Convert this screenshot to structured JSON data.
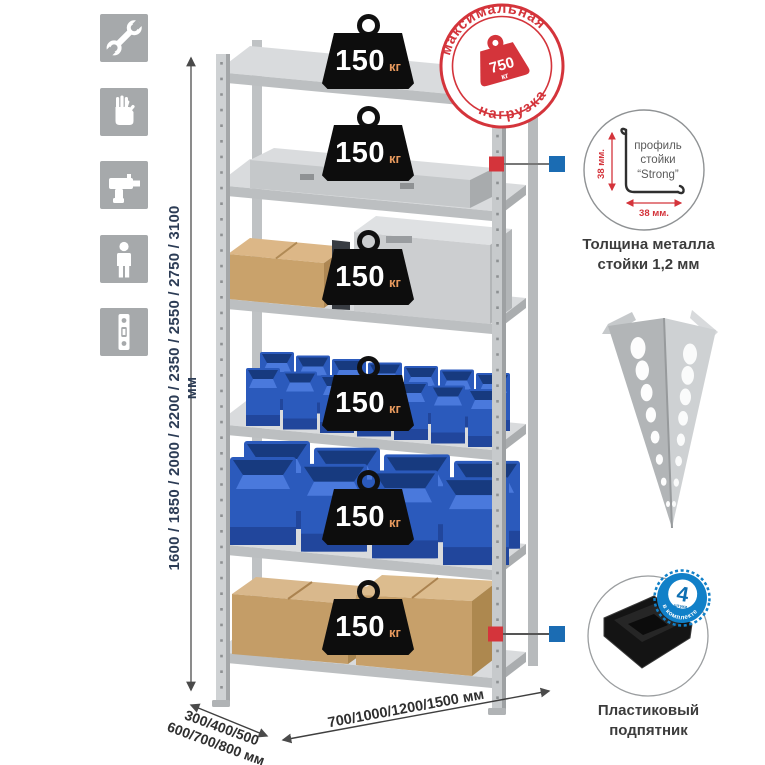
{
  "assembly_icons": [
    "wrench-icon",
    "gloves-icon",
    "drill-icon",
    "person-icon",
    "upright-profile-icon"
  ],
  "dimensions": {
    "height": "1600 / 1850 / 2000 / 2200 / 2350 / 2550 / 2750 / 3100 мм",
    "depth_line1": "300/400/500",
    "depth_line2": "600/700/800 мм",
    "width": "700/1000/1200/1500 мм"
  },
  "shelves": [
    {
      "load": "150",
      "unit": "кг"
    },
    {
      "load": "150",
      "unit": "кг"
    },
    {
      "load": "150",
      "unit": "кг"
    },
    {
      "load": "150",
      "unit": "кг"
    },
    {
      "load": "150",
      "unit": "кг"
    },
    {
      "load": "150",
      "unit": "кг"
    }
  ],
  "max_load_stamp": {
    "arc_top": "максимальная",
    "arc_bottom": "нагрузка",
    "value": "750",
    "unit": "кг"
  },
  "profile_detail": {
    "line1": "профиль",
    "line2": "стойки",
    "line3": "“Strong”",
    "dim_vertical": "38 мм.",
    "dim_horizontal": "38 мм.",
    "caption_line1": "Толщина металла",
    "caption_line2": "стойки 1,2 мм"
  },
  "foot_detail": {
    "badge_value": "4",
    "badge_sub": "штуки",
    "badge_arc": "в комплекте",
    "caption_line1": "Пластиковый",
    "caption_line2": "подпятник"
  },
  "colors": {
    "accent_red": "#d4343b",
    "accent_blue": "#1180c8",
    "metal_gray": "#c9ccce",
    "bin_blue": "#2f63cf",
    "cardboard": "#c9a26b",
    "badge_black": "#0d0d0d",
    "dim_text": "#2c3c55"
  }
}
